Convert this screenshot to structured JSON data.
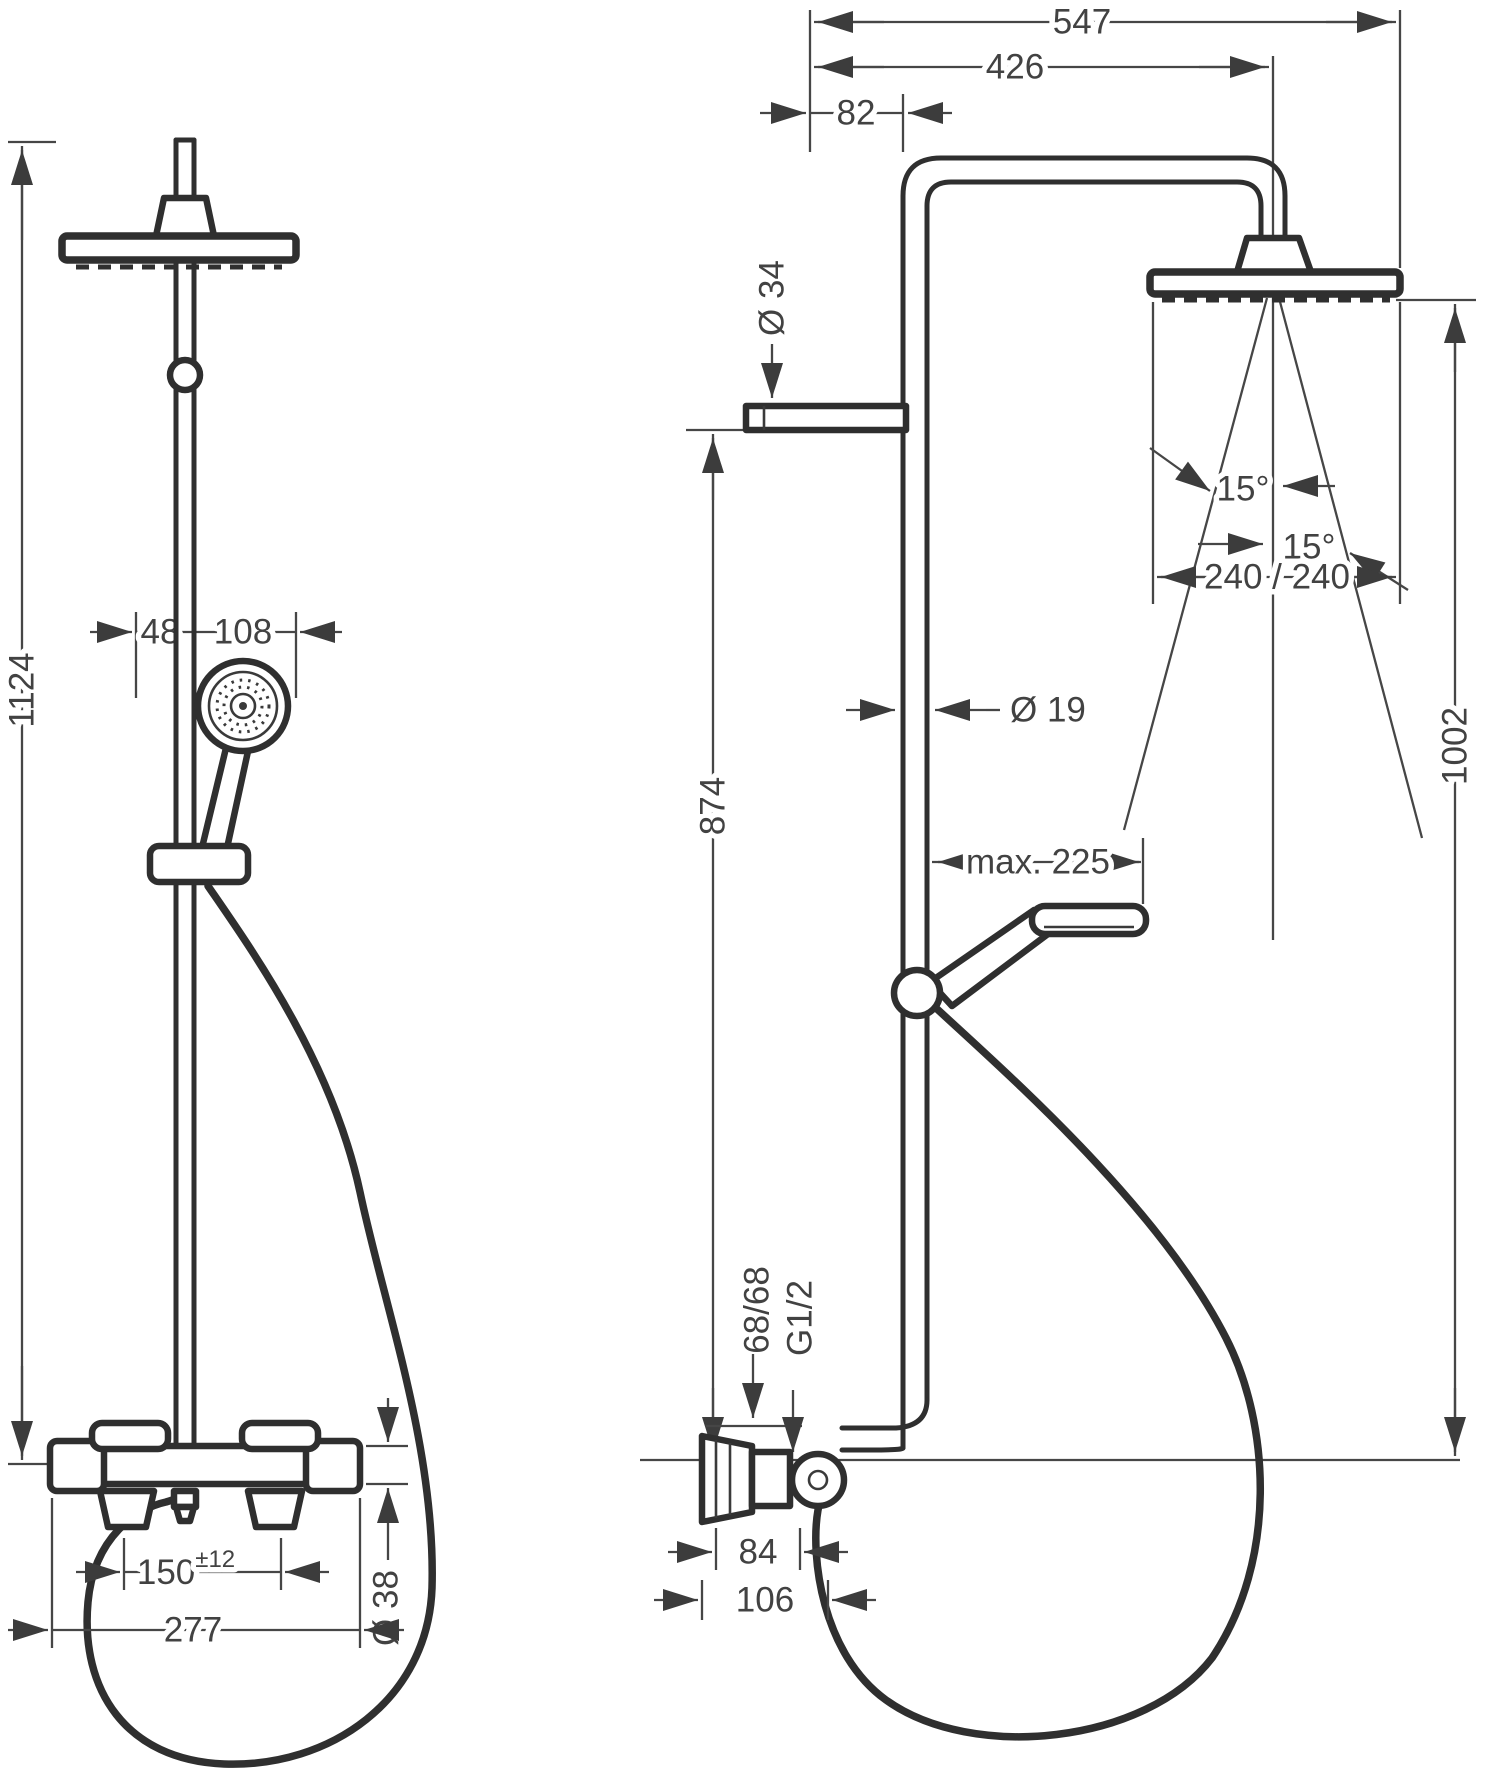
{
  "colors": {
    "background": "#ffffff",
    "product_lines": "#2f2f2f",
    "dimension_lines": "#464646",
    "text": "#424242"
  },
  "views": {
    "front": {
      "total_height": "1124",
      "hand_shower_offset": "48",
      "hand_shower_head_width": "108",
      "supply_spacing": "150",
      "supply_spacing_tolerance": "±12",
      "trim_width": "277",
      "valve_body_diameter": "Ø 38"
    },
    "side": {
      "head_overall_projection": "547",
      "arm_projection": "426",
      "riser_wall_offset": "82",
      "wall_bracket_diameter": "Ø 34",
      "riser_pipe_diameter": "Ø 19",
      "riser_height": "874",
      "head_height_above_supply": "1002",
      "spray_angle_inner": "15°",
      "spray_angle_outer": "15°",
      "spray_footprint": "240 / 240",
      "hand_shower_projection": "max. 225",
      "supply_offset": "68/68",
      "supply_thread": "G1/2",
      "escutcheon_width": "84",
      "escutcheon_projection": "106"
    }
  }
}
